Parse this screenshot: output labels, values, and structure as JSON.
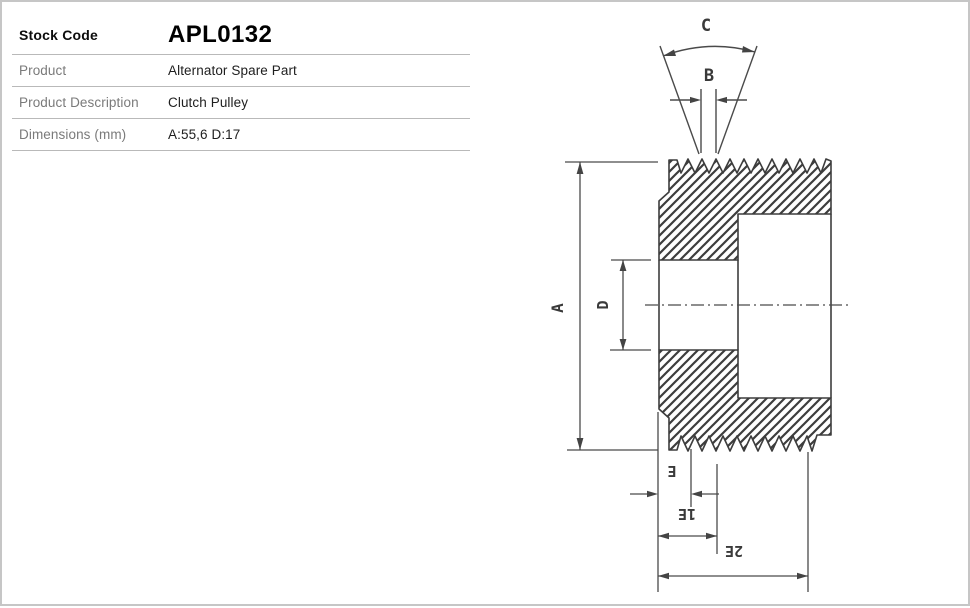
{
  "spec_table": {
    "rows": [
      {
        "label": "Stock Code",
        "value": "APL0132"
      },
      {
        "label": "Product",
        "value": "Alternator Spare Part"
      },
      {
        "label": "Product Description",
        "value": "Clutch Pulley"
      },
      {
        "label": "Dimensions (mm)",
        "value": "A:55,6 D:17"
      }
    ]
  },
  "diagram": {
    "labels": {
      "A": "A",
      "B": "B",
      "C": "C",
      "D": "D",
      "E": "E",
      "E1": "E1",
      "E2": "E2"
    }
  },
  "colors": {
    "outline": "#3d3d3d",
    "dimension_lines": "#4a4a4a",
    "table_divider": "#b9b9b9",
    "label_text": "#7a7a7a",
    "value_text": "#1e1e1e",
    "page_border": "#c6c6c6"
  }
}
